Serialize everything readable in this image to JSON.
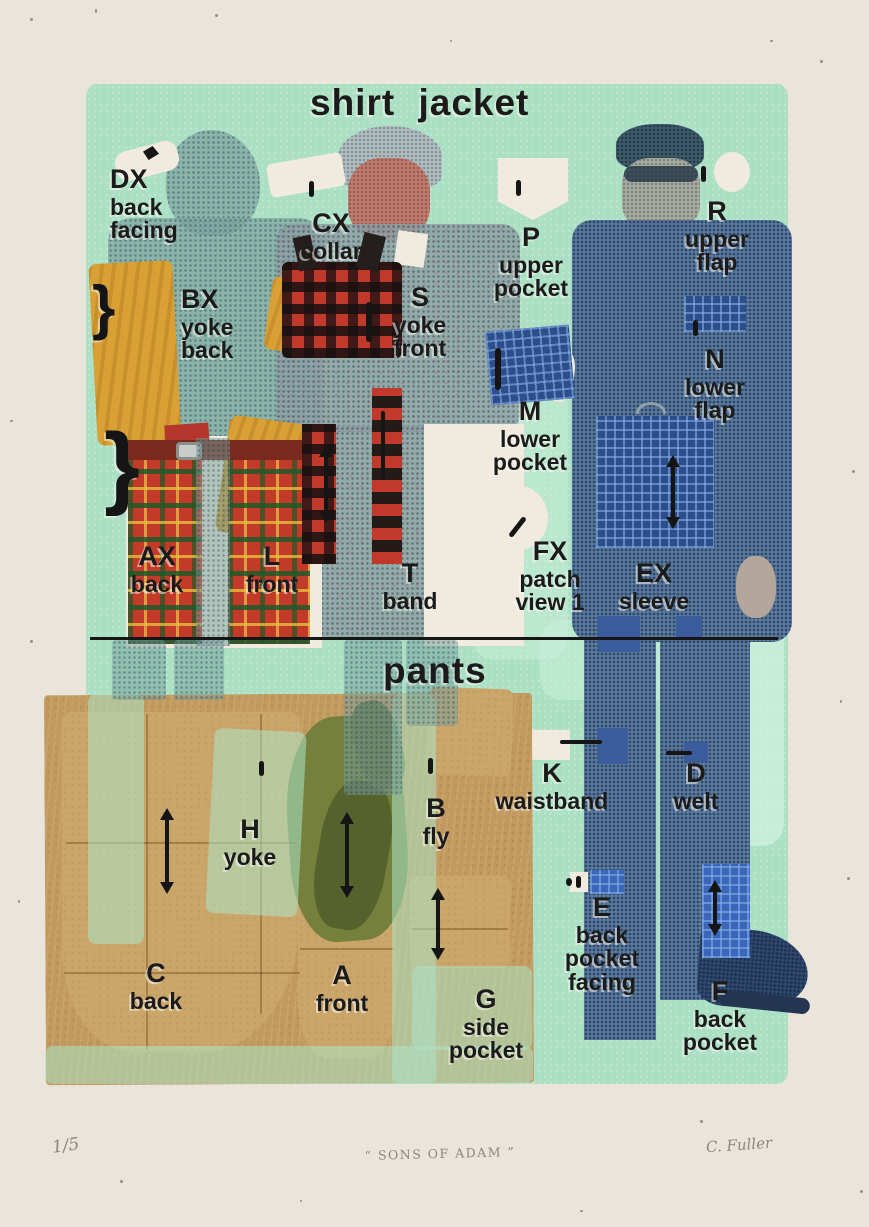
{
  "artwork": {
    "titles": {
      "shirt_jacket": "shirt jacket",
      "pants": "pants"
    },
    "shirt_jacket_labels": [
      {
        "code": "DX",
        "name": "back\nfacing"
      },
      {
        "code": "CX",
        "name": "collar"
      },
      {
        "code": "P",
        "name": "upper\npocket"
      },
      {
        "code": "R",
        "name": "upper\nflap"
      },
      {
        "code": "BX",
        "name": "yoke\nback"
      },
      {
        "code": "S",
        "name": "yoke\nfront"
      },
      {
        "code": "N",
        "name": "lower\nflap"
      },
      {
        "code": "M",
        "name": "lower\npocket"
      },
      {
        "code": "AX",
        "name": "back"
      },
      {
        "code": "L",
        "name": "front"
      },
      {
        "code": "T",
        "name": "band"
      },
      {
        "code": "FX",
        "name": "patch\nview 1"
      },
      {
        "code": "EX",
        "name": "sleeve"
      }
    ],
    "pants_labels": [
      {
        "code": "H",
        "name": "yoke"
      },
      {
        "code": "B",
        "name": "fly"
      },
      {
        "code": "K",
        "name": "waistband"
      },
      {
        "code": "D",
        "name": "welt"
      },
      {
        "code": "E",
        "name": "back\npocket\nfacing"
      },
      {
        "code": "C",
        "name": "back"
      },
      {
        "code": "A",
        "name": "front"
      },
      {
        "code": "G",
        "name": "side\npocket"
      },
      {
        "code": "F",
        "name": "back\npocket"
      }
    ],
    "glyphs": {
      "brace": "}"
    },
    "margin": {
      "edition": "1/5",
      "title": "“ SONS OF ADAM ”",
      "signature": "C. Fuller"
    },
    "colors": {
      "paper": "#eae4da",
      "print_green": "#abe0c4",
      "ink": "#1b1b1b",
      "kraft": "#c2995e",
      "navy": "#3a5c9c",
      "mustard": "#d9a135",
      "tartan_red": "#c23a28",
      "pencil": "#8d867a"
    }
  }
}
